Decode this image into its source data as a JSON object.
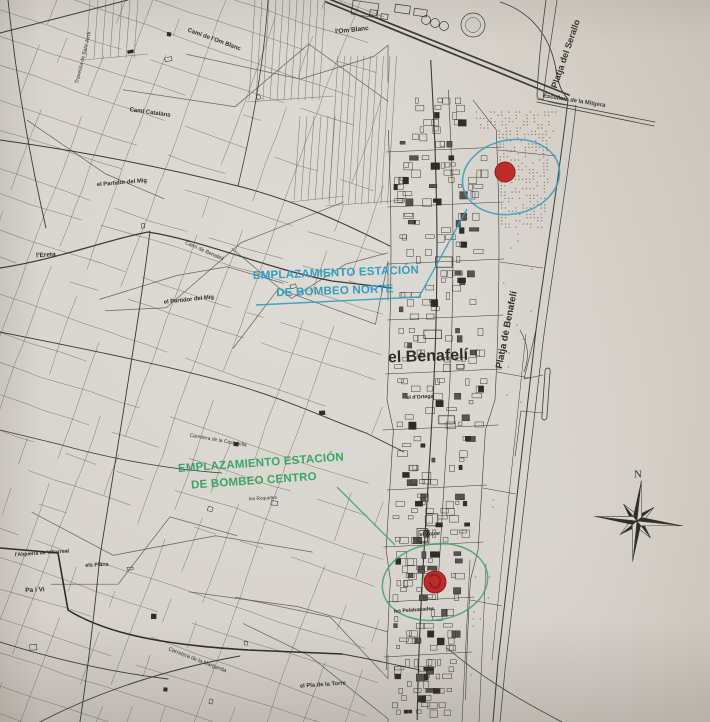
{
  "colors": {
    "paper": "#d9d6d0",
    "ink": "#2e2c29",
    "road": "#3a3835",
    "parcel": "#6e6a64",
    "boundary": "#55524d",
    "blue": "#2f9ec2",
    "green": "#3aa568",
    "red": "#bf2927",
    "red_dark": "#8c1f1e",
    "stipple": "#8d867c"
  },
  "compass": {
    "letter": "N"
  },
  "annotations": {
    "norte": {
      "line1": "EMPLAZAMIENTO ESTACIÓN",
      "line2": "DE BOMBEO NORTE"
    },
    "centro": {
      "line1": "EMPLAZAMIENTO ESTACIÓN",
      "line2": "DE BOMBEO CENTRO"
    }
  },
  "labels": [
    {
      "id": "om-blanc",
      "text": "l'Om Blanc",
      "x": 352,
      "y": 31,
      "rot": -6,
      "size": 6.5,
      "weight": 700,
      "color": "ink"
    },
    {
      "id": "cami-om-blanc",
      "text": "Camí de l'Om Blanc",
      "x": 214,
      "y": 40,
      "rot": 20,
      "size": 6,
      "weight": 700,
      "color": "ink"
    },
    {
      "id": "cami-catalans",
      "text": "Camí Catalans",
      "x": 150,
      "y": 113,
      "rot": 8,
      "size": 6,
      "weight": 700,
      "color": "ink"
    },
    {
      "id": "travessa-sant-jordi",
      "text": "Travessa de Sant Jordi",
      "x": 84,
      "y": 58,
      "rot": -76,
      "size": 5.2,
      "weight": 400,
      "color": "ink"
    },
    {
      "id": "partidor-del-mig-nord",
      "text": "el Partidor del Mig",
      "x": 122,
      "y": 184,
      "rot": -5,
      "size": 5.8,
      "weight": 700,
      "color": "ink"
    },
    {
      "id": "cami-de-benafeli",
      "text": "Camí de Benafelí",
      "x": 204,
      "y": 252,
      "rot": 24,
      "size": 5.4,
      "weight": 400,
      "color": "ink"
    },
    {
      "id": "partidor-del-mig-sud",
      "text": "el Partidor del Mig",
      "x": 189,
      "y": 301,
      "rot": -6,
      "size": 5.8,
      "weight": 700,
      "color": "ink"
    },
    {
      "id": "ereta",
      "text": "l'Ereta",
      "x": 46,
      "y": 256,
      "rot": -4,
      "size": 6.5,
      "weight": 700,
      "color": "ink"
    },
    {
      "id": "alqueria-villarreal",
      "text": "l'Alqueria de Villarreal",
      "x": 42,
      "y": 554,
      "rot": -4,
      "size": 5.2,
      "weight": 700,
      "color": "ink"
    },
    {
      "id": "els-plans",
      "text": "els Plans",
      "x": 97,
      "y": 566,
      "rot": -3,
      "size": 5.4,
      "weight": 700,
      "color": "ink"
    },
    {
      "id": "pa-i-vi",
      "text": "Pa i Vi",
      "x": 35,
      "y": 591,
      "rot": -3,
      "size": 6.5,
      "weight": 700,
      "color": "ink"
    },
    {
      "id": "carretera-cassalella",
      "text": "Carretera de la Cassalella",
      "x": 218,
      "y": 441,
      "rot": 10,
      "size": 5,
      "weight": 400,
      "color": "ink"
    },
    {
      "id": "les-roquetes",
      "text": "les Roquetes",
      "x": 263,
      "y": 500,
      "rot": -3,
      "size": 4.8,
      "weight": 400,
      "color": "ink"
    },
    {
      "id": "el-xopar",
      "text": "el Xopar",
      "x": 430,
      "y": 535,
      "rot": -4,
      "size": 5.2,
      "weight": 700,
      "color": "ink"
    },
    {
      "id": "les-pelabanades",
      "text": "les Pelabanades",
      "x": 414,
      "y": 611,
      "rot": -4,
      "size": 5.2,
      "weight": 700,
      "color": "ink"
    },
    {
      "id": "carretera-margarida",
      "text": "Carretera de la Margarida",
      "x": 197,
      "y": 661,
      "rot": 21,
      "size": 5.4,
      "weight": 400,
      "color": "ink"
    },
    {
      "id": "pla-de-la-torre",
      "text": "el Pla de la Torre",
      "x": 323,
      "y": 686,
      "rot": -4,
      "size": 5.8,
      "weight": 700,
      "color": "ink"
    },
    {
      "id": "el-benafeli",
      "text": "el Benafelí",
      "x": 428,
      "y": 357,
      "rot": -2,
      "size": 16,
      "weight": 700,
      "color": "ink"
    },
    {
      "id": "el-dortega",
      "text": "el d'Ortega",
      "x": 420,
      "y": 398,
      "rot": -3,
      "size": 5.2,
      "weight": 700,
      "color": "ink"
    },
    {
      "id": "platja-de-benafeli",
      "text": "Platja de Benafelí",
      "x": 507,
      "y": 330,
      "rot": -79,
      "size": 9.5,
      "weight": 700,
      "color": "ink"
    },
    {
      "id": "platja-del-serallo",
      "text": "Platja del Serallo",
      "x": 566,
      "y": 54,
      "rot": -71,
      "size": 9,
      "weight": 700,
      "color": "ink"
    },
    {
      "id": "escullera-mitgera",
      "text": "Escullera de la Mitgera",
      "x": 574,
      "y": 102,
      "rot": 9,
      "size": 5.8,
      "weight": 700,
      "color": "ink"
    },
    {
      "id": "estacion-norte-line1",
      "text": "EMPLAZAMIENTO ESTACIÓN",
      "x": 336,
      "y": 274,
      "rot": -2,
      "size": 11.5,
      "weight": 700,
      "color": "blue",
      "ls": 0.2
    },
    {
      "id": "estacion-norte-line2",
      "text": "DE BOMBEO NORTE",
      "x": 335,
      "y": 292,
      "rot": -2,
      "size": 11.5,
      "weight": 700,
      "color": "blue",
      "ls": 0.2
    },
    {
      "id": "estacion-centro-line1",
      "text": "EMPLAZAMIENTO ESTACIÓN",
      "x": 261,
      "y": 464,
      "rot": -4,
      "size": 11.5,
      "weight": 700,
      "color": "green",
      "ls": 0.2
    },
    {
      "id": "estacion-centro-line2",
      "text": "DE BOMBEO CENTRO",
      "x": 254,
      "y": 482,
      "rot": -4,
      "size": 11.5,
      "weight": 700,
      "color": "green",
      "ls": 0.2
    },
    {
      "id": "compass-n",
      "text": "N",
      "x": 638,
      "y": 475,
      "rot": 0,
      "size": 11,
      "weight": 400,
      "color": "ink",
      "font": "serif"
    }
  ]
}
